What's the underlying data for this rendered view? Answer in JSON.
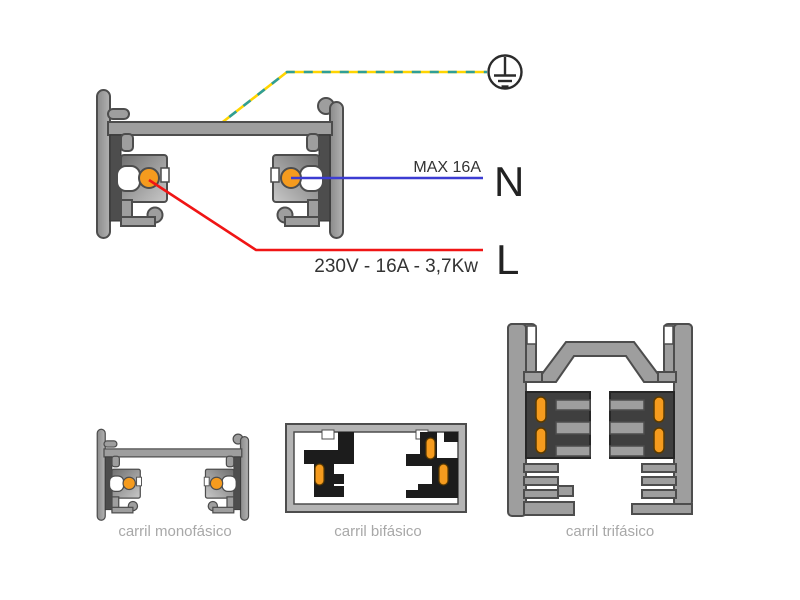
{
  "main": {
    "max_current_label": "MAX 16A",
    "neutral_terminal": "N",
    "phase_terminal": "L",
    "phase_spec_label": "230V - 16A - 3,7Kw"
  },
  "tracks": [
    {
      "label": "carril monofásico"
    },
    {
      "label": "carril bifásico"
    },
    {
      "label": "carril trifásico"
    }
  ],
  "icons": [
    {
      "name": "earth-ground-icon",
      "meaning": "protective earth symbol"
    }
  ],
  "colors": {
    "neutral_wire_blue": "#3c3cd2",
    "phase_wire_red": "#f01515",
    "earth_yellow": "#ffd400",
    "earth_green": "#2f9e96",
    "conductor_orange": "#f59b1e",
    "profile_gray": "#9e9e9e",
    "insulator_dark": "#3f3f3f",
    "bifasico_black": "#1c1c1c",
    "caption_gray": "#a8a8a8",
    "text_dark": "#333333"
  }
}
